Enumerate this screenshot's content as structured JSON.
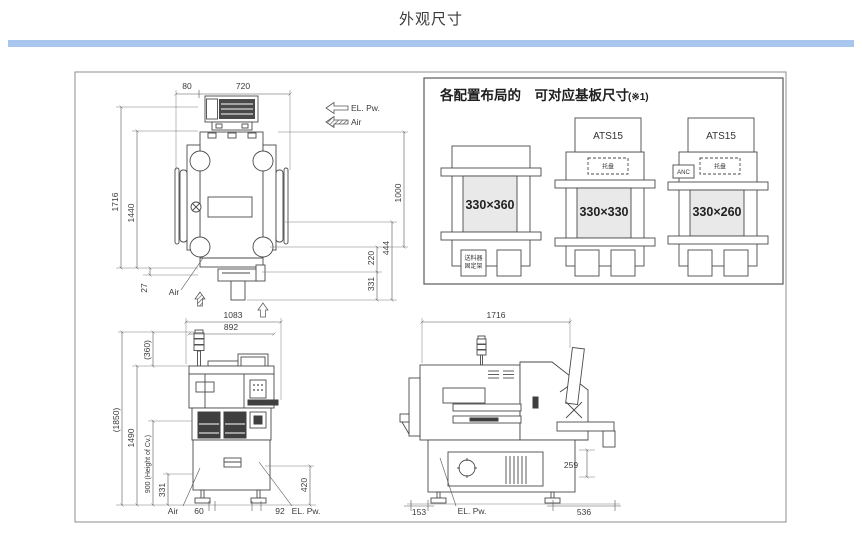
{
  "title": "外观尺寸",
  "colors": {
    "accent_bar": "#a9c6ee",
    "line": "#4a4a4a",
    "board_fill": "#e9e9e9"
  },
  "legend": {
    "el_pw": "EL. Pw.",
    "air": "Air"
  },
  "top_view": {
    "d80": "80",
    "d720": "720",
    "d1716": "1716",
    "d1440": "1440",
    "d27": "27",
    "d1000": "1000",
    "d444": "444",
    "d220": "220",
    "d331": "331",
    "air": "Air"
  },
  "config_panel": {
    "title": "各配置布局的　可对应基板尺寸",
    "note": "(※1)",
    "c1": {
      "size": "330×360",
      "feeder1": "送料器",
      "feeder2": "固定架"
    },
    "c2": {
      "ats": "ATS15",
      "tray": "托盘",
      "size": "330×330"
    },
    "c3": {
      "ats": "ATS15",
      "tray": "托盘",
      "anc": "ANC",
      "size": "330×260"
    }
  },
  "front_view": {
    "d1083": "1083",
    "d892": "892",
    "d360": "(360)",
    "d1850": "(1850)",
    "d1490": "1490",
    "d900": "900 (Height of Cv.)",
    "d331": "331",
    "d420": "420",
    "d60": "60",
    "d92": "92",
    "air": "Air",
    "el_pw": "EL. Pw."
  },
  "side_view": {
    "d1716": "1716",
    "d259": "259",
    "d153": "153",
    "d536": "536",
    "el_pw": "EL. Pw."
  }
}
